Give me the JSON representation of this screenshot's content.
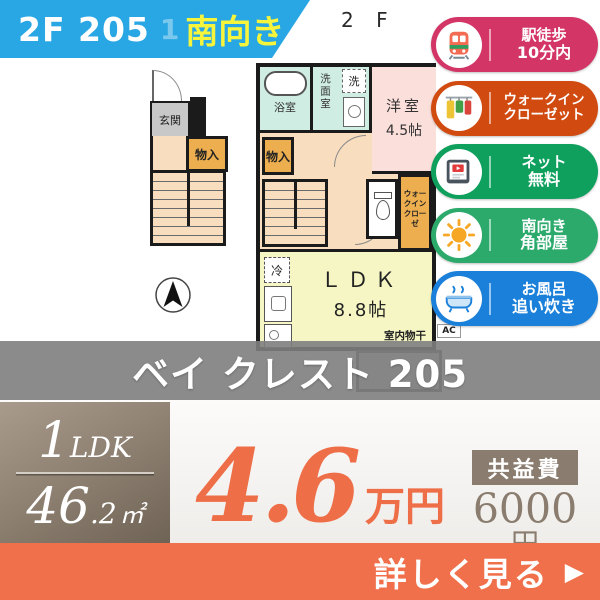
{
  "ribbon": {
    "unit": "2F 205",
    "watermark": "1",
    "facing": "南向き",
    "bg_color": "#29A7E4",
    "facing_color": "#F6F53C"
  },
  "plan": {
    "floor_label": "2 F",
    "genkan": "玄関",
    "storage_1f": "物入",
    "storage_2f": "物入",
    "bath": "浴室",
    "washroom": "洗面室",
    "laundry": "洗",
    "western_room_line1": "洋室",
    "western_room_line2": "4.5帖",
    "wic_line1": "ウォークイン",
    "wic_line2": "クローゼ",
    "ldk_line1": "ＬＤＫ",
    "ldk_line2": "8.8帖",
    "indoor_drying": "室内物干",
    "fridge": "冷",
    "ac": "AC"
  },
  "badges": [
    {
      "icon": "train",
      "line1": "駅徒歩",
      "line2": "10分内",
      "color": "#D23566"
    },
    {
      "icon": "closet",
      "line1": "ウォークイン",
      "line2": "クローゼット",
      "color": "#D14A10"
    },
    {
      "icon": "internet",
      "line1": "ネット",
      "line2": "無料",
      "color": "#0FA05E"
    },
    {
      "icon": "sun",
      "line1": "南向き",
      "line2": "角部屋",
      "color": "#2BAA6B"
    },
    {
      "icon": "bathtub",
      "line1": "お風呂",
      "line2": "追い炊き",
      "color": "#1B80DA"
    }
  ],
  "banner": {
    "building_name": "ベイ クレスト 205"
  },
  "summary": {
    "layout_num": "1",
    "layout_suffix": "LDK",
    "area_num": "46",
    "area_dec": ".2",
    "area_unit": "㎡",
    "rent_value": "4.6",
    "rent_unit": "万円",
    "rent_color": "#EE6E48",
    "fee_label": "共益費",
    "fee_value": "6000",
    "fee_unit": "円"
  },
  "cta": {
    "label": "詳しく見る",
    "arrow": "▶",
    "bg_color": "#F0704B"
  }
}
